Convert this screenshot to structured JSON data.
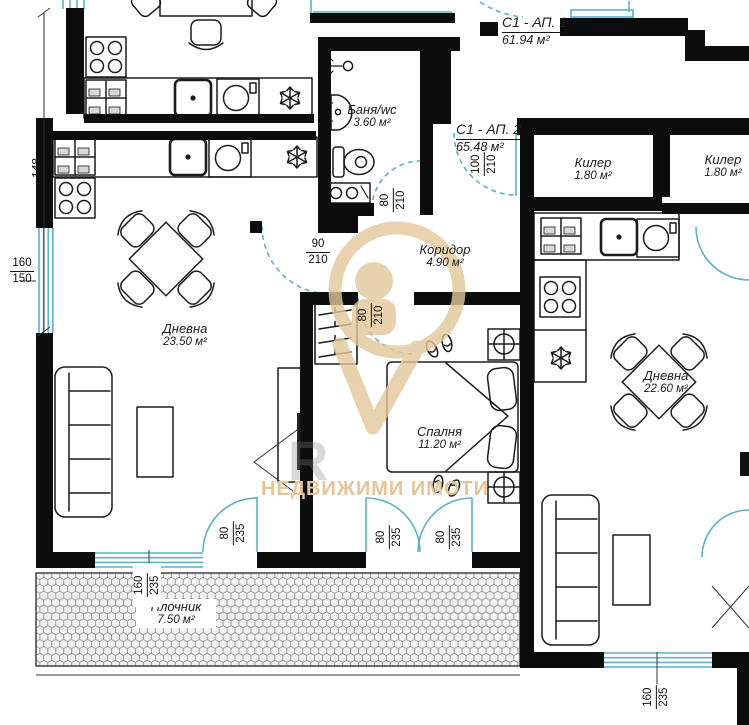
{
  "apartments": {
    "ap1": {
      "name": "С1 - АП. 1",
      "area": "61.94 м²"
    },
    "ap2": {
      "name": "С1 - АП. 2",
      "area": "65.48 м²"
    }
  },
  "rooms": {
    "bath": {
      "name": "Баня/wc",
      "area": "3.60 м²"
    },
    "corridor": {
      "name": "Коридор",
      "area": "4.90 м²"
    },
    "living1": {
      "name": "Дневна",
      "area": "23.50 м²"
    },
    "bedroom": {
      "name": "Спалня",
      "area": "11.20 м²"
    },
    "terrace": {
      "name": "Плочник",
      "area": "7.50 м²"
    },
    "storage1": {
      "name": "Килер",
      "area": "1.80 м²"
    },
    "storage2": {
      "name": "Килер",
      "area": "1.80 м²"
    },
    "living2": {
      "name": "Дневна",
      "area": "22.60 м²"
    },
    "upper_partial": {
      "area": "1.80 м²"
    }
  },
  "dimensions": {
    "wall_left": "148",
    "win_left": {
      "w": "160",
      "h": "150"
    },
    "entry_door": {
      "w": "100",
      "h": "210"
    },
    "living_door": {
      "w": "90",
      "h": "210"
    },
    "bath_door": {
      "w": "80",
      "h": "210"
    },
    "bedroom_door": {
      "w": "80",
      "h": "210"
    },
    "terrace_door": {
      "w": "80",
      "h": "235"
    },
    "french_left": {
      "w": "80",
      "h": "235"
    },
    "french_right": {
      "w": "80",
      "h": "235"
    },
    "win_sw": {
      "w": "160",
      "h": "235"
    },
    "win_se": {
      "w": "160",
      "h": "235"
    }
  },
  "watermark": {
    "brand_text": "НЕДВИЖИМИ ИМОТИ",
    "faint_letter": "R"
  },
  "icons": {
    "fridge": "snowflake-icon",
    "stove": "four-burner-icon",
    "sink": "basin-dot-icon",
    "washer": "drum-circle-icon",
    "lamp": "circle-cross-icon"
  },
  "colors": {
    "wall": "#0d0d0d",
    "opening": "#5cb0c8",
    "watermark": "#e3c79b",
    "hex_tile": "#8a8a8a"
  }
}
